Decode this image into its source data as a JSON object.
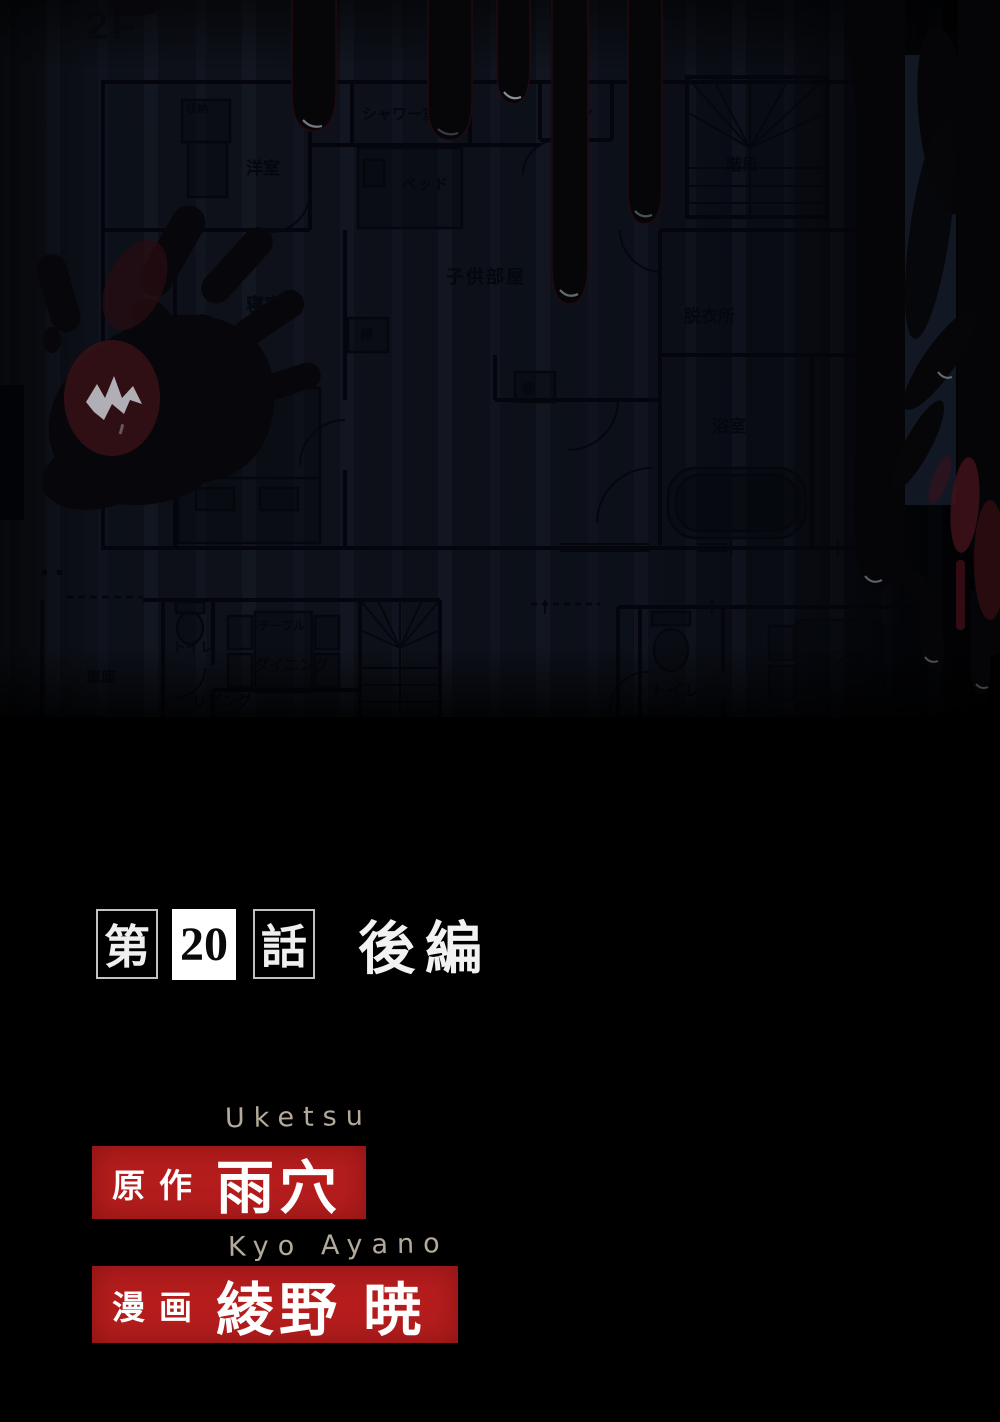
{
  "plan": {
    "floor_label": "2F",
    "labels2f": {
      "closet": "収納",
      "shower": "シャワー室",
      "toilet_top": "トイレ",
      "western_room": "洋室",
      "bed_top": "ベッド",
      "kids_room": "子供部屋",
      "stairs": "階段",
      "bedroom": "寝室",
      "shelf_a": "棚",
      "shelf_b": "棚",
      "dressing": "脱衣所",
      "balcony": "バルコニー",
      "bed_bottom": "ベッド",
      "bath": "浴室"
    },
    "labels1f": {
      "garage": "車庫",
      "toilet_left": "トイレ",
      "table_left": "テーブル",
      "dining": "ダイニング",
      "living": "リビング",
      "toilet_right": "トイレ",
      "table_right": "テーブル"
    }
  },
  "title": {
    "prefix": "第",
    "number": "20",
    "suffix": "話",
    "part": "後編"
  },
  "credits": {
    "author_romaji": "Uketsu",
    "author_role": "原作",
    "author_name": "雨穴",
    "artist_romaji": "Kyo Ayano",
    "artist_role": "漫画",
    "artist_name": "綾野 暁"
  },
  "colors": {
    "credit_box_red": "#b51d1d",
    "plan_paper": "#10141d",
    "blood_black": "#060609",
    "blood_red": "#3a1116",
    "romaji_tan": "#b3aa9b"
  }
}
